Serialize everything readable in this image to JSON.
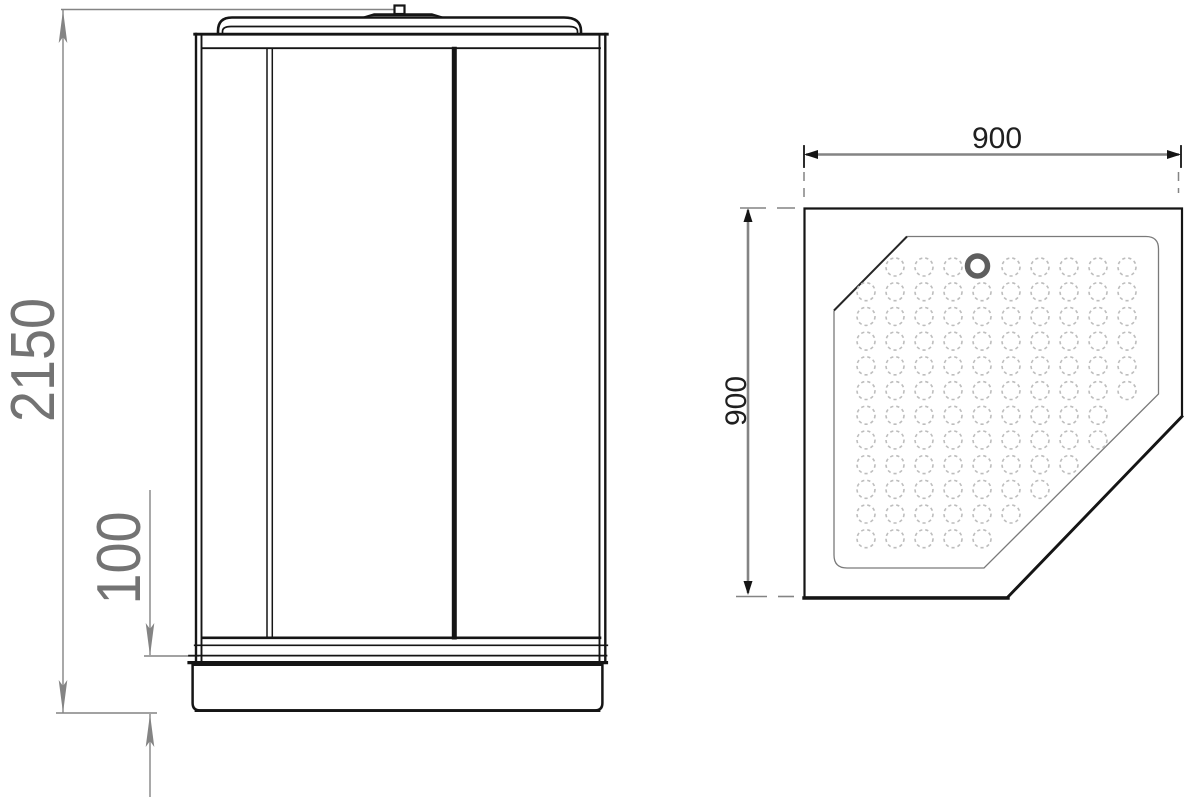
{
  "front_view": {
    "overall_height_label": "2150",
    "tray_height_label": "100"
  },
  "top_view": {
    "width_label": "900",
    "depth_label": "900",
    "dot_grid": {
      "origin_x": 866,
      "origin_y": 267,
      "cols": 10,
      "rows": 12,
      "dx": 29,
      "dy": 24.7,
      "radius": 9,
      "clip_min_sum": 1146,
      "clip_max_sum": 1542,
      "skip": [
        [
          0,
          4
        ]
      ]
    },
    "drain": {
      "cx": 977.5,
      "cy": 266,
      "r": 10,
      "stroke_width": 5.5
    }
  },
  "colors": {
    "line": "#151515",
    "inner_line": "#7a7a7a",
    "inner_dark": "#262626",
    "dim_line": "#848484",
    "dim_text_gray": "#737373",
    "dim_text_dark": "#1f1f1f",
    "dot": "#bdbdbd",
    "drain": "#5e5e5e",
    "background": "#ffffff"
  }
}
